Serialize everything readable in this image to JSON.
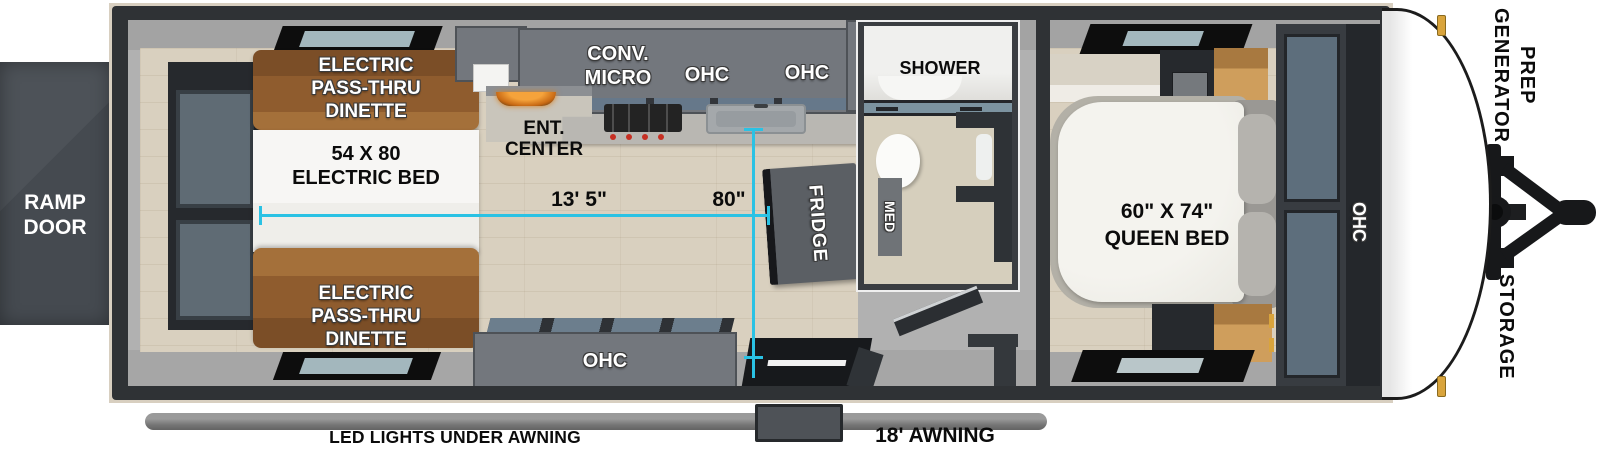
{
  "title": "Travel trailer floorplan - top view",
  "ramp": {
    "lines": [
      "RAMP",
      "DOOR"
    ]
  },
  "rear": {
    "dinette_top": [
      "ELECTRIC",
      "PASS-THRU",
      "DINETTE"
    ],
    "bed": [
      "54 X 80",
      "ELECTRIC BED"
    ],
    "dinette_bottom": [
      "ELECTRIC",
      "PASS-THRU",
      "DINETTE"
    ]
  },
  "kitchen": {
    "conv_micro": [
      "CONV.",
      "MICRO"
    ],
    "ohc_left": "OHC",
    "ohc_right": "OHC",
    "ent_center": [
      "ENT.",
      "CENTER"
    ],
    "ohc_bottom": "OHC",
    "fridge": "FRIDGE"
  },
  "bath": {
    "shower": "SHOWER",
    "med": "MED"
  },
  "bedroom": {
    "bed": [
      "60\" X 74\"",
      "QUEEN BED"
    ],
    "ohc_wardrobe": "OHC"
  },
  "front": {
    "generator_prep": [
      "GENERATOR",
      "PREP"
    ],
    "storage": "STORAGE"
  },
  "bottom": {
    "led": "LED LIGHTS UNDER AWNING",
    "awning": "18' AWNING"
  },
  "dims": {
    "length": "13' 5\"",
    "width": "80\""
  },
  "colors": {
    "dimension_accent": "#2ac2e4",
    "frame_dark": "#2f3235",
    "trim_tan": "#d8cfc0",
    "dinette_brown": "#8f5c2e",
    "cabinet_gray": "#73777d",
    "floor_wood": "#d9d0bf",
    "latch_gold": "#d9a43c"
  }
}
